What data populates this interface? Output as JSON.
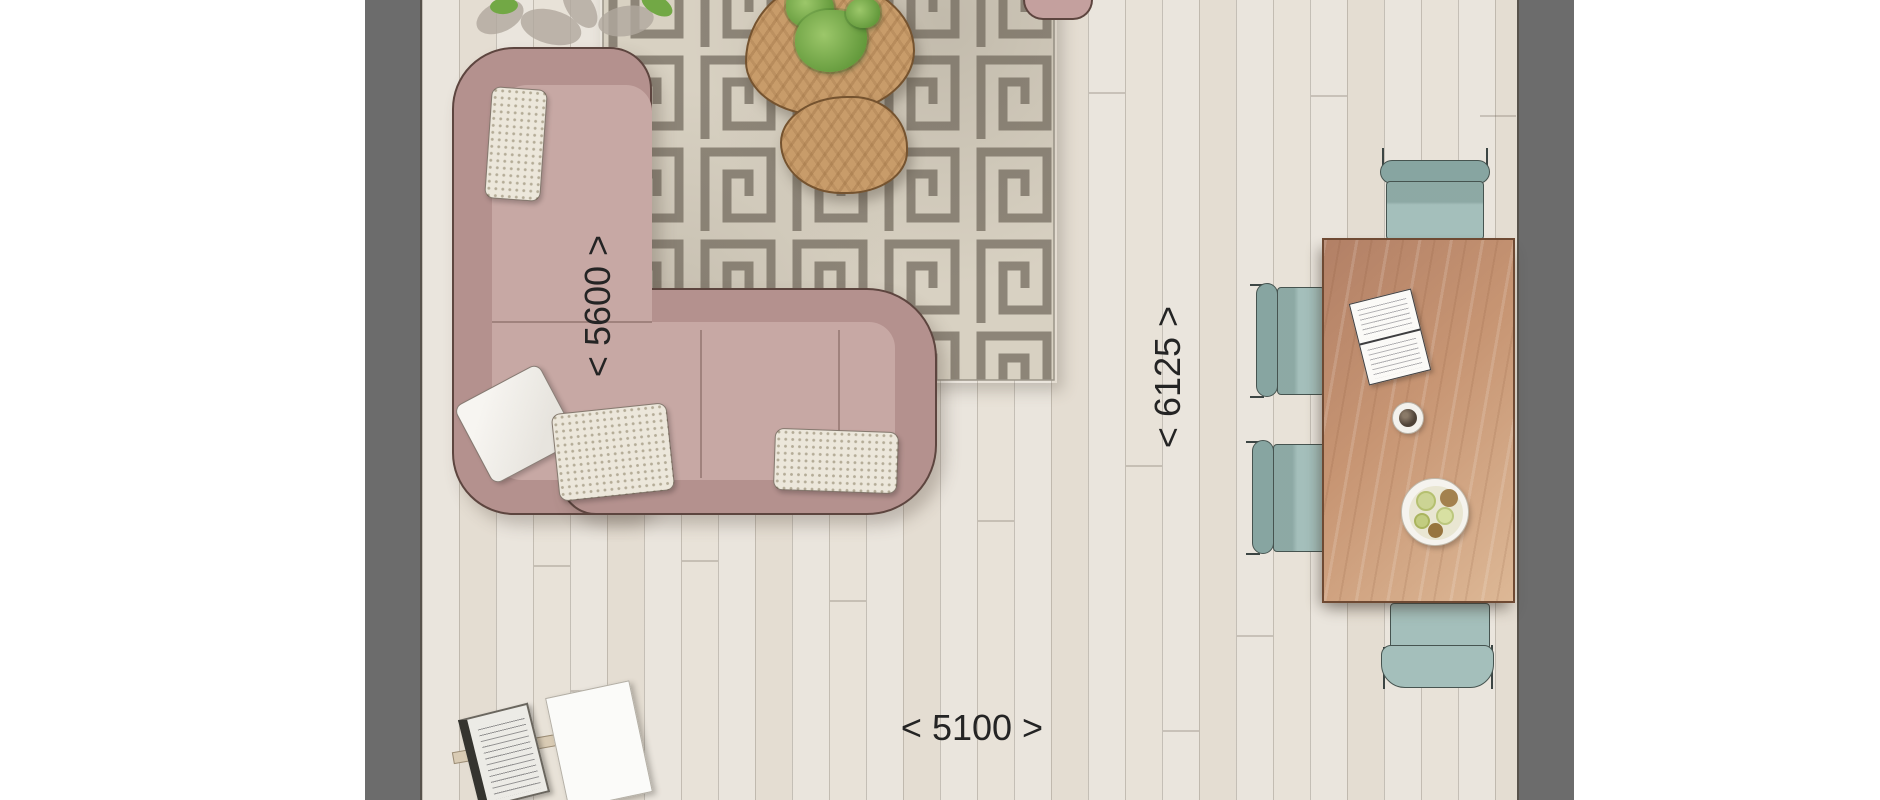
{
  "scene": {
    "type": "floor-plan",
    "room": "living-dining-room",
    "style": "top-view render"
  },
  "dimensions": {
    "d5600": {
      "label": "< 5600 >",
      "value": "5600",
      "orientation": "vertical",
      "along": "sofa-wall"
    },
    "d6125": {
      "label": "< 6125 >",
      "value": "6125",
      "orientation": "vertical",
      "along": "room-depth"
    },
    "d5100": {
      "label": "< 5100 >",
      "value": "5100",
      "orientation": "horizontal",
      "along": "room-width"
    }
  },
  "objects": {
    "sofa": "l-shaped corner sofa, dusty rose, 4 pillows",
    "rug": "greek-key meander rug, gray on cream",
    "coffee_tables": "two kidney-shaped wood nesting tables",
    "plant_on_table": "green potted plant",
    "plant_corner": "leafy plant partially visible at top-left",
    "dining_table": "rectangular wood dining table",
    "dining_chairs": "four teal chairs (top, two left, bottom)",
    "tableware": "open notebook, coffee cup, fruit bowl",
    "magazine_stand": "magazine rack with open magazine",
    "paper_sheet": "white sheet on floor",
    "walls": "gray wall bands left and right"
  },
  "colors": {
    "wall": "#6c6c6c",
    "floor": "#eae5dd",
    "floor-seam": "#b9b2a6",
    "sofa-back": "#b4918e",
    "sofa-seat": "#c7a8a4",
    "sofa-outline": "#5d453f",
    "rug-base": "#d8d1c2",
    "rug-pattern": "#8d8578",
    "coffee-wood": "#c89c6a",
    "dining-wood": "#c4906c",
    "chair-teal": "#a4bfbb",
    "chair-teal-dark": "#87a5a1",
    "plant-green": "#79ad4c",
    "text": "#242424"
  }
}
